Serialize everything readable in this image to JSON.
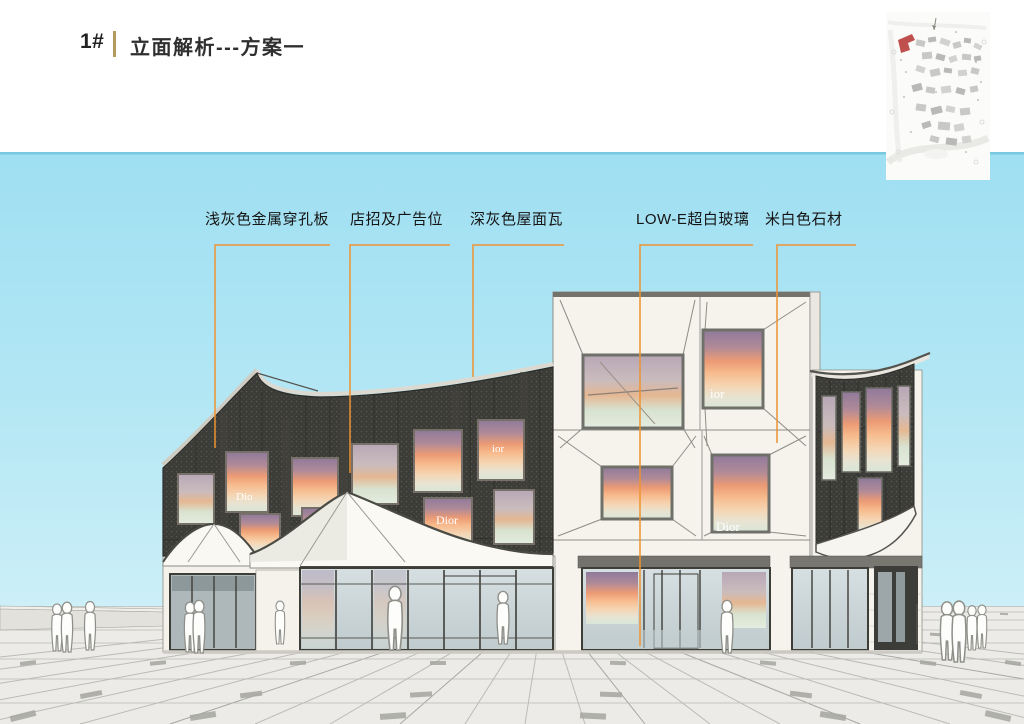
{
  "slide": {
    "number": "1#",
    "title": "立面解析---方案一"
  },
  "annotations": [
    {
      "label": "浅灰色金属穿孔板"
    },
    {
      "label": "店招及广告位"
    },
    {
      "label": "深灰色屋面瓦"
    },
    {
      "label": "LOW-E超白玻璃"
    },
    {
      "label": "米白色石材"
    }
  ],
  "signage": {
    "brand": "Dior",
    "brand_partial_dio": "Dio",
    "brand_partial_ior": "ior"
  },
  "colors": {
    "leader_orange": "#ed9333",
    "title_divider_gold": "#b5995a",
    "sky_blue": "#a9e2f2",
    "facade_dark": "#3b3b37",
    "stone_white": "#f5f3ec",
    "map_highlight_red": "#c0504d"
  }
}
